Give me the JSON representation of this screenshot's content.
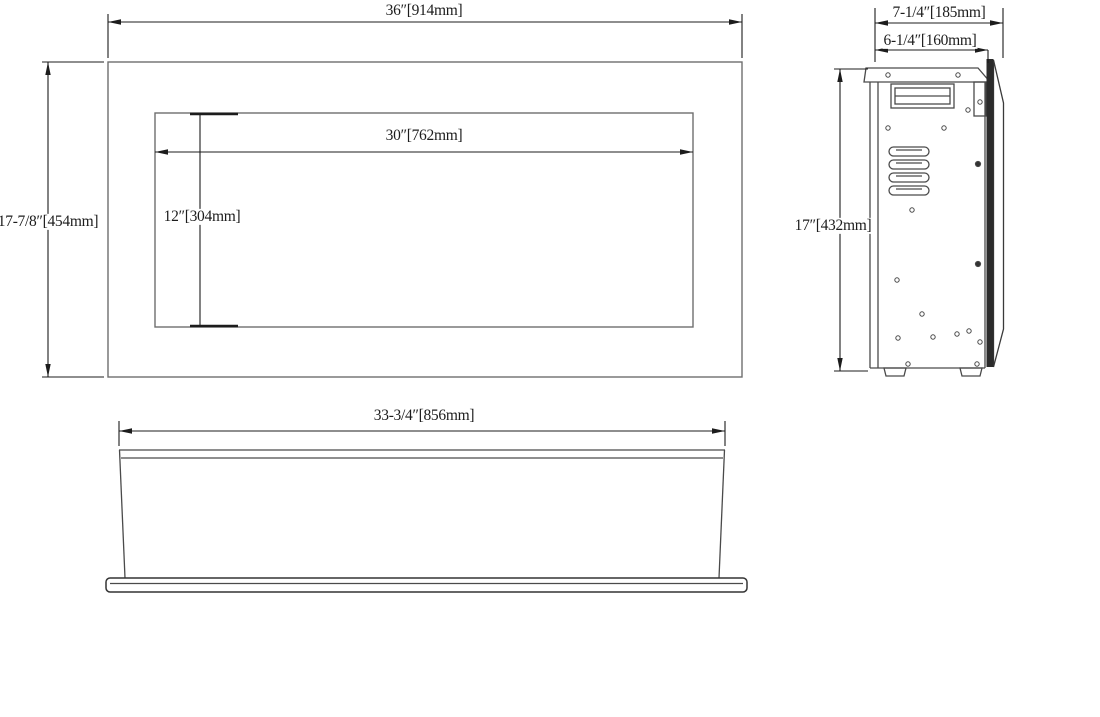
{
  "colors": {
    "outline_gray": "#6e6e6e",
    "outline_dark": "#4a4a4a",
    "dimension_line": "#1c1c1c",
    "panel_fill": "#2b2b2b",
    "background": "#ffffff"
  },
  "front_view": {
    "overall_width": "36″[914mm]",
    "overall_height": "17-7/8″[454mm]",
    "opening_width": "30″[762mm]",
    "opening_height": "12″[304mm]"
  },
  "side_view": {
    "overall_depth": "7-1/4″[185mm]",
    "body_depth": "6-1/4″[160mm]",
    "height": "17″[432mm]"
  },
  "bottom_view": {
    "width": "33-3/4″[856mm]"
  }
}
